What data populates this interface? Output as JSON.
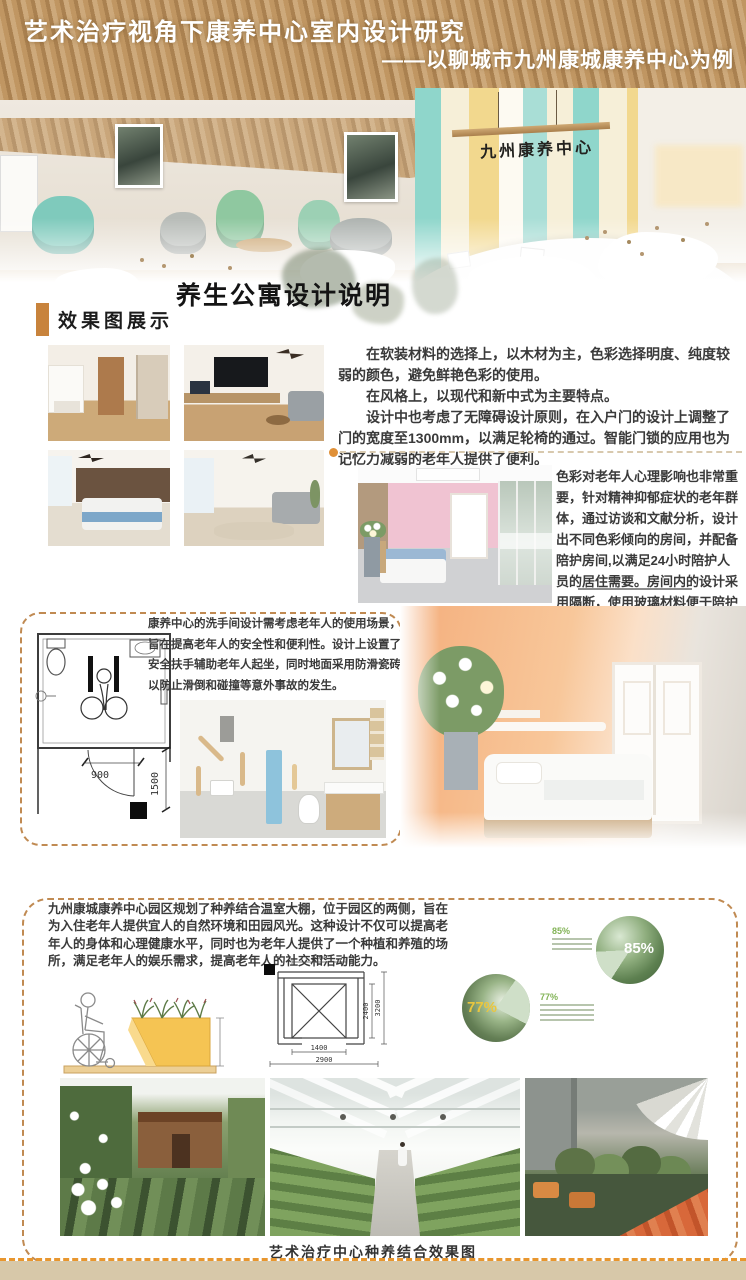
{
  "header": {
    "title": "艺术治疗视角下康养中心室内设计研究",
    "subtitle": "——以聊城市九州康城康养中心为例",
    "sign_text": "九州康养中心"
  },
  "sections": {
    "apartment_heading": "养生公寓设计说明",
    "renderings_label": "效果图展示",
    "caption": "艺术治疗中心种养结合效果图"
  },
  "paragraphs": {
    "soft_materials": "在软装材料的选择上，以木材为主，色彩选择明度、纯度较弱的颜色，避免鲜艳色彩的使用。",
    "style": "在风格上，以现代和新中式为主要特点。",
    "accessibility": "设计中也考虑了无障碍设计原则，在入户门的设计上调整了门的宽度至1300mm，以满足轮椅的通过。智能门锁的应用也为记忆力减弱的老年人提供了便利。",
    "color_psychology": "色彩对老年人心理影响也非常重要，针对精神抑郁症状的老年群体，通过访谈和文献分析，设计出不同色彩倾向的房间，并配备陪护房间,以满足24小时陪护人员的居住需要。房间内的设计采用隔断，使用玻璃材料便于陪护人员随时观察。",
    "bathroom": "康养中心的洗手间设计需考虑老年人的使用场景，旨在提高老年人的安全性和便利性。设计上设置了安全扶手辅助老年人起坐，同时地面采用防滑瓷砖以防止滑倒和碰撞等意外事故的发生。",
    "greenhouse": "九州康城康养中心园区规划了种养结合温室大棚，位于园区的两侧，旨在为入住老年人提供宜人的自然环境和田园风光。这种设计不仅可以提高老年人的身体和心理健康水平，同时也为老年人提供了一个种植和养殖的场所，满足老年人的娱乐需求，提高老年人的社交和活动能力。"
  },
  "bathroom_plan": {
    "dim_width": "900",
    "dim_height": "1500"
  },
  "planter_frame": {
    "dim_top": "1400",
    "dim_inner_height": "2400",
    "dim_outer_height": "3200",
    "dim_inner_width": "1400",
    "dim_outer_width": "2900"
  },
  "stats": {
    "stat1": "85%",
    "stat2": "77%"
  },
  "chart_data": [
    {
      "type": "pie",
      "values": [
        85,
        15
      ],
      "labels": [
        "85%",
        ""
      ],
      "legend_position": "left",
      "note": "circle filled with greenhouse gardening photo; light-green slice is remainder"
    },
    {
      "type": "pie",
      "values": [
        77,
        23
      ],
      "labels": [
        "77%",
        ""
      ],
      "legend_position": "right",
      "note": "circle filled with elder-and-child gardening photo; light-green slice is remainder"
    }
  ],
  "colors": {
    "accent_orange": "#c8833c",
    "dashed_border": "#c08a52",
    "bottom_dash": "#e8962e",
    "footer_beige": "#d7c8a9",
    "stat_green": "#82b356",
    "pie_slice_green": "#cfdfc8",
    "stripe_teal": "#8fd6cb",
    "stripe_yellow": "#f2d88e"
  }
}
